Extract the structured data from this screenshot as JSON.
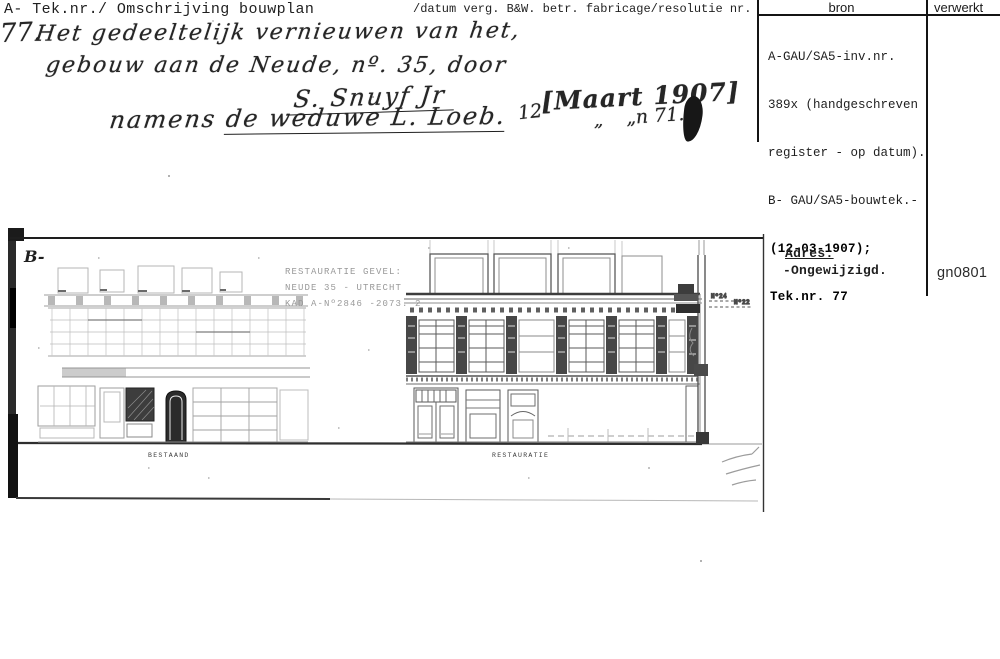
{
  "header": {
    "left_label": "A- Tek.nr./ Omschrijving bouwplan",
    "center_label": "/datum verg. B&W. betr. fabricage/resolutie nr.",
    "columns": {
      "bron": "bron",
      "verwerkt": "verwerkt"
    }
  },
  "bron_cell": {
    "typed_lines": [
      "A-GAU/SA5-inv.nr.",
      "389x (handgeschreven",
      "register - op datum).",
      "B- GAU/SA5-bouwtek.-"
    ],
    "stamped_lines": [
      "(12-03-1907);",
      "Tek.nr. 77"
    ]
  },
  "adres_block": {
    "label": "Adres:",
    "value": "-Ongewijzigd."
  },
  "verwerkt_cell": {
    "code": "gn0801"
  },
  "handwritten": {
    "number": "77.",
    "line1": "Het gedeeltelijk vernieuwen van het,",
    "line2": "gebouw aan de Neude, nº. 35, door",
    "line3": "S. Snuyf Jr",
    "line4_prefix": "namens ",
    "line4_underlined": "de weduwe L. Loeb.",
    "date_day": "12",
    "date_bracket": "[Maart 1907]",
    "date_quote": "„",
    "date_note": "„n 71."
  },
  "drawing": {
    "sheet_label": "B-",
    "stamp_lines": [
      "RESTAURATIE  GEVEL:",
      "NEUDE 35 - UTRECHT",
      "KAD A-Nº2846 -2073. 2"
    ],
    "caption_left": "BESTAAND",
    "caption_right": "RESTAURATIE",
    "section_label_1": "Nº24",
    "section_label_2": "Nº22"
  }
}
